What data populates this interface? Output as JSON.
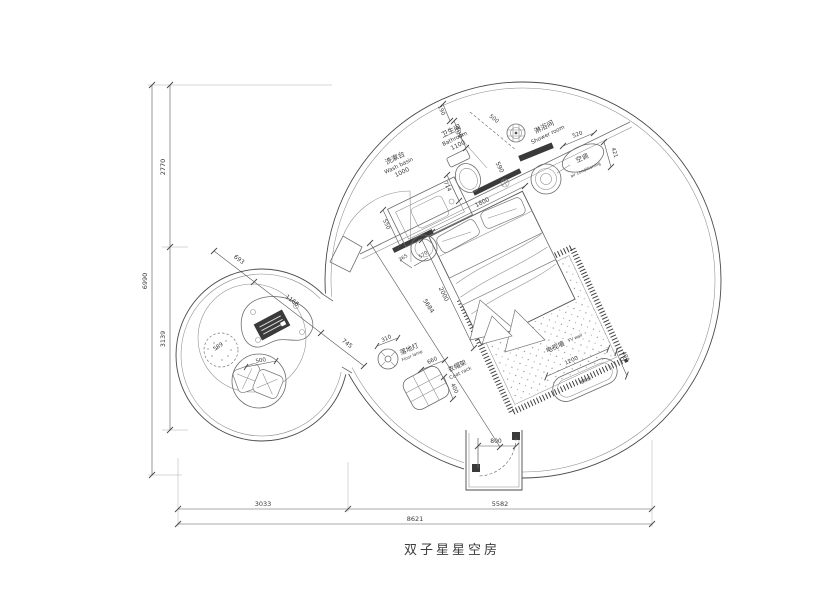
{
  "title": "双子星星空房",
  "labels": {
    "washbasin_zh": "洗漱台",
    "washbasin_en": "Wash basin",
    "bathroom_zh": "卫生间",
    "bathroom_en": "Bathroom",
    "shower_zh": "淋浴间",
    "shower_en": "Shower room",
    "ac_zh": "空调",
    "ac_en": "air conditioning",
    "floor_lamp_zh": "落地灯",
    "floor_lamp_en": "Floor lamp",
    "coat_rack_zh": "衣帽架",
    "coat_rack_en": "Coat rack",
    "tv_wall_zh": "电视墙",
    "tv_wall_en": "TV wall",
    "tv_cabinet_zh": "电视柜"
  },
  "dims": {
    "left_total": "6990",
    "left_upper": "2770",
    "left_lower": "3139",
    "bottom_left": "3033",
    "bottom_right": "5582",
    "bottom_total": "8621",
    "entry_door": "800",
    "bed_width": "1800",
    "bed_length": "2000",
    "room_diagonal": "5684",
    "washbasin_len": "1000",
    "bathroom_len": "1100",
    "vanity_depth": "550",
    "toilet_width": "714",
    "wall_top": "190",
    "bath_door": "700",
    "shower_door": "500",
    "wall_inner": "590",
    "shower_width": "520",
    "ac_depth": "421",
    "stool_a": "365",
    "stool_b": "570",
    "lamp_d": "310",
    "rack_w": "660",
    "rack_h": "400",
    "tv_len": "1200",
    "tv_depth": "400",
    "axis_a": "693",
    "axis_b": "1166",
    "axis_c": "745",
    "pouf_d": "589",
    "cushion_d": "500"
  }
}
